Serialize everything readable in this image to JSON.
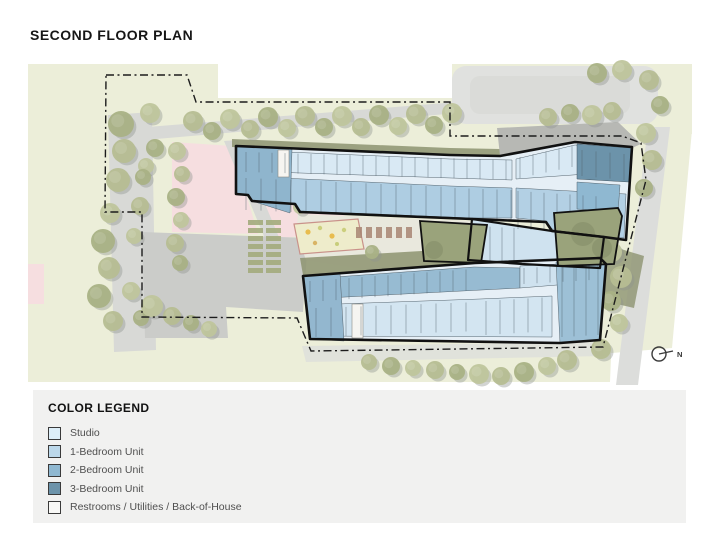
{
  "title": "SECOND FLOOR PLAN",
  "plan": {
    "north_label": "N",
    "palette": {
      "site_green": "#eceed9",
      "road_gray": "#d8d9d6",
      "parking_gray": "#cbccc9",
      "olive": "#8d9370",
      "pink": "#f6dee0",
      "outline": "#111111",
      "corridor": "#e6eff6",
      "courtyard_green": "#9aa37b",
      "tree_greens": [
        "#b6bd92",
        "#a9b185",
        "#bfc59c"
      ],
      "tree_shadow": "#8f948f",
      "divider": "#4d5d68"
    },
    "trees": [
      [
        193,
        121,
        10
      ],
      [
        212,
        131,
        9
      ],
      [
        230,
        119,
        10
      ],
      [
        250,
        129,
        9
      ],
      [
        268,
        117,
        10
      ],
      [
        287,
        128,
        9
      ],
      [
        305,
        116,
        10
      ],
      [
        324,
        127,
        9
      ],
      [
        342,
        116,
        10
      ],
      [
        361,
        127,
        9
      ],
      [
        379,
        115,
        10
      ],
      [
        398,
        126,
        9
      ],
      [
        416,
        114,
        10
      ],
      [
        434,
        125,
        9
      ],
      [
        452,
        113,
        10
      ],
      [
        548,
        117,
        9
      ],
      [
        570,
        113,
        9
      ],
      [
        592,
        115,
        10
      ],
      [
        612,
        111,
        9
      ],
      [
        597,
        73,
        10
      ],
      [
        622,
        70,
        10
      ],
      [
        649,
        80,
        10
      ],
      [
        660,
        105,
        9
      ],
      [
        646,
        133,
        10
      ],
      [
        652,
        160,
        10
      ],
      [
        644,
        188,
        9
      ],
      [
        612,
        252,
        10
      ],
      [
        621,
        277,
        11
      ],
      [
        611,
        301,
        10
      ],
      [
        619,
        323,
        9
      ],
      [
        601,
        349,
        10
      ],
      [
        121,
        124,
        13
      ],
      [
        150,
        113,
        10
      ],
      [
        124,
        151,
        12
      ],
      [
        155,
        148,
        9
      ],
      [
        146,
        166,
        8
      ],
      [
        118,
        180,
        12
      ],
      [
        143,
        177,
        8
      ],
      [
        110,
        213,
        10
      ],
      [
        140,
        206,
        9
      ],
      [
        103,
        241,
        12
      ],
      [
        134,
        236,
        8
      ],
      [
        109,
        268,
        11
      ],
      [
        99,
        296,
        12
      ],
      [
        131,
        291,
        9
      ],
      [
        113,
        321,
        10
      ],
      [
        141,
        318,
        8
      ],
      [
        177,
        151,
        9
      ],
      [
        182,
        174,
        8
      ],
      [
        176,
        197,
        9
      ],
      [
        181,
        220,
        8
      ],
      [
        175,
        243,
        9
      ],
      [
        180,
        263,
        8
      ],
      [
        152,
        306,
        11
      ],
      [
        172,
        316,
        9
      ],
      [
        191,
        323,
        8
      ],
      [
        209,
        329,
        8
      ],
      [
        369,
        362,
        8
      ],
      [
        391,
        366,
        9
      ],
      [
        413,
        368,
        8
      ],
      [
        435,
        370,
        9
      ],
      [
        457,
        372,
        8
      ],
      [
        479,
        374,
        10
      ],
      [
        501,
        376,
        9
      ],
      [
        524,
        372,
        10
      ],
      [
        547,
        366,
        9
      ],
      [
        567,
        360,
        10
      ],
      [
        372,
        252,
        7
      ],
      [
        300,
        207,
        7
      ]
    ],
    "divider_sets": [
      [
        246,
        152,
        512,
        160,
        20,
        13
      ],
      [
        520,
        157,
        572,
        146,
        21,
        13
      ],
      [
        582,
        150,
        624,
        154,
        26,
        14
      ],
      [
        246,
        178,
        450,
        187,
        32,
        15
      ],
      [
        455,
        188,
        512,
        190,
        30,
        14
      ],
      [
        518,
        191,
        608,
        197,
        38,
        13
      ],
      [
        478,
        226,
        514,
        228,
        34,
        12
      ],
      [
        310,
        281,
        472,
        269,
        21,
        13
      ],
      [
        524,
        268,
        592,
        264,
        16,
        13
      ],
      [
        316,
        308,
        478,
        302,
        29,
        15
      ],
      [
        486,
        301,
        550,
        297,
        34,
        14
      ],
      [
        562,
        267,
        598,
        265,
        70,
        12
      ]
    ],
    "garden": {
      "x": 248,
      "y": 220,
      "rows": 7,
      "cols": 2,
      "w": 15,
      "h": 5,
      "dx": 18,
      "dy": 8
    }
  },
  "legend": {
    "title": "COLOR LEGEND",
    "items": [
      {
        "label": "Studio",
        "color": "#ddeef8"
      },
      {
        "label": "1-Bedroom Unit",
        "color": "#bcd8ea"
      },
      {
        "label": "2-Bedroom Unit",
        "color": "#8fb8d1"
      },
      {
        "label": "3-Bedroom Unit",
        "color": "#6c93aa"
      },
      {
        "label": "Restrooms / Utilities / Back-of-House",
        "color": "#f8f8f6"
      }
    ]
  }
}
